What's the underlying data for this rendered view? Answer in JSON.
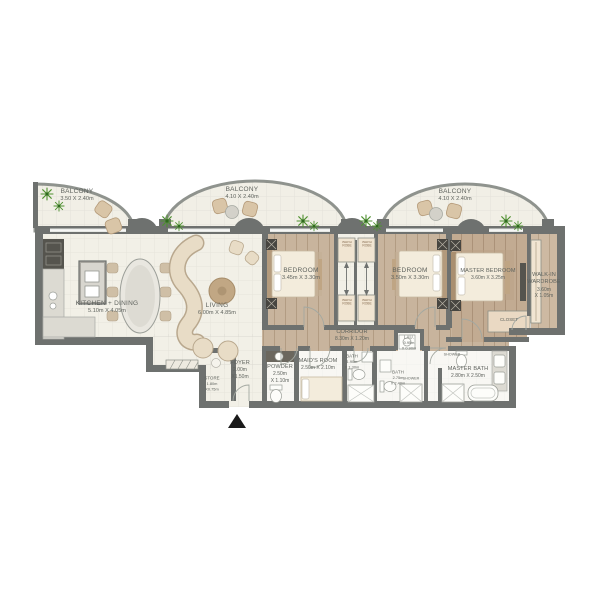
{
  "colors": {
    "wall": "#6e716f",
    "cream_floor": "#f2f0e7",
    "wood_floor": "#c8b49d",
    "master_wood_floor": "#c2ab92",
    "plant_green": "#4f9130",
    "entrance_marker": "#1a1a1a"
  },
  "balconies": [
    {
      "name": "BALCONY",
      "dims": "3.50 X 2.40m"
    },
    {
      "name": "BALCONY",
      "dims": "4.10 X 2.40m"
    },
    {
      "name": "BALCONY",
      "dims": "4.10 X 2.40m"
    }
  ],
  "rooms": {
    "kitchen": {
      "name": "KITCHEN + DINING",
      "dims": "5.10m X 4.05m"
    },
    "living": {
      "name": "LIVING",
      "dims": "6.00m X 4.85m"
    },
    "bedroom1": {
      "name": "BEDROOM",
      "dims": "3.45m X 3.30m"
    },
    "bedroom2": {
      "name": "BEDROOM",
      "dims": "3.50m X 3.30m"
    },
    "master_bedroom": {
      "name": "MASTER BEDROOM",
      "dims": "3.60m X 3.25m"
    },
    "walk_in_wardrobe": {
      "name": "WALK-IN",
      "name2": "WARDROBE",
      "dims": "3.60m",
      "dims2": "X 1.05m"
    },
    "corridor": {
      "name": "CORRIDOR",
      "dims": "8.30m X 1.20m"
    },
    "foyer": {
      "name": "FOYER",
      "dims": "2.00m",
      "dims2": "X1.50m"
    },
    "store": {
      "name": "STORE",
      "dims": "1.80m",
      "dims2": "X0.75m"
    },
    "powder": {
      "name": "POWDER",
      "dims": "2.50m",
      "dims2": "X 1.10m"
    },
    "maids_room": {
      "name": "MAID'S ROOM",
      "dims": "2.50m X 2.10m"
    },
    "bath": {
      "name": "BATH",
      "dims": "1.90m",
      "dims2": "X 1.30m"
    },
    "bath2": {
      "name": "BATH",
      "dims": "2.75m",
      "dims2": "X 2.40m"
    },
    "master_bath": {
      "name": "MASTER BATH",
      "dims": "2.80m X 2.50m"
    },
    "laundry": {
      "name": "LAU.",
      "dims": "0.95m",
      "dims2": "X 0.90m"
    },
    "closet": {
      "name": "CLOSET"
    }
  },
  "fixtures": {
    "wardrobe": "WARD ROBE",
    "shower": "SHOWER"
  }
}
